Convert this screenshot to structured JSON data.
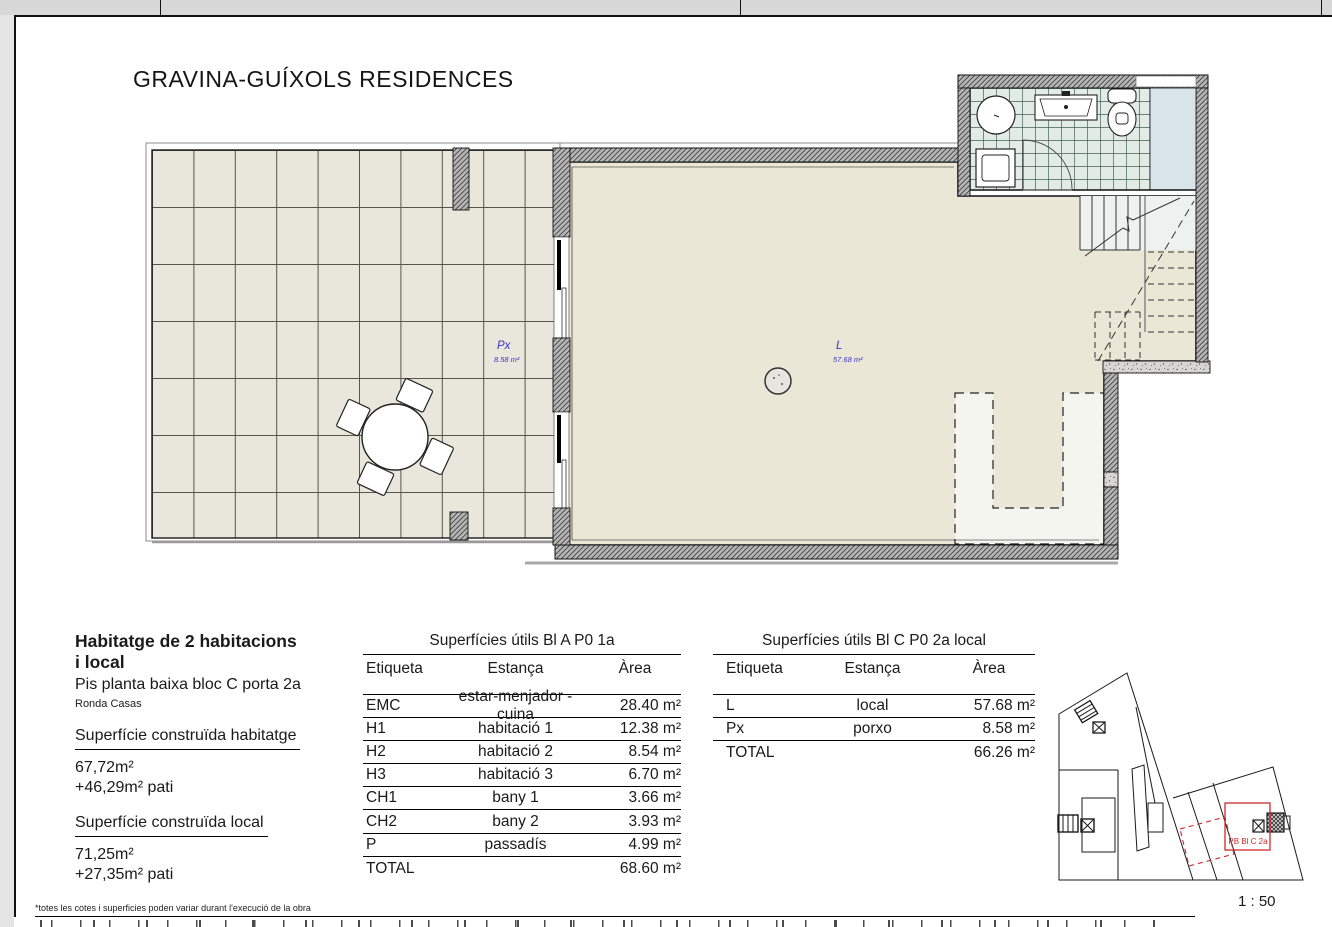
{
  "page": {
    "title": "GRAVINA-GUÍXOLS RESIDENCES",
    "scale_label": "1 : 50",
    "footnote": "*totes les cotes i superficies poden variar durant l'execució de la obra"
  },
  "plan": {
    "porxo_code": "Px",
    "porxo_area": "8.58 m²",
    "local_code": "L",
    "local_area": "57.68 m²"
  },
  "unit_info": {
    "title_line1": "Habitatge de 2 habitacions",
    "title_line2": "i local",
    "subtitle": "Pis planta baixa bloc C porta 2a",
    "address": "Ronda Casas",
    "built_dwelling_label": "Superfície construïda habitatge",
    "built_dwelling_area": "67,72m²",
    "built_dwelling_patio": "+46,29m² pati",
    "built_local_label": "Superfície construïda local",
    "built_local_area": "71,25m²",
    "built_local_patio": "+27,35m² pati"
  },
  "table_a": {
    "title": "Superfícies útils Bl A P0 1a",
    "col_label": "Etiqueta",
    "col_room": "Estança",
    "col_area": "Àrea",
    "rows": [
      {
        "label": "EMC",
        "room": "estar-menjador -cuina",
        "area": "28.40 m²"
      },
      {
        "label": "H1",
        "room": "habitació 1",
        "area": "12.38 m²"
      },
      {
        "label": "H2",
        "room": "habitació 2",
        "area": "8.54 m²"
      },
      {
        "label": "H3",
        "room": "habitació 3",
        "area": "6.70 m²"
      },
      {
        "label": "CH1",
        "room": "bany 1",
        "area": "3.66 m²"
      },
      {
        "label": "CH2",
        "room": "bany 2",
        "area": "3.93 m²"
      },
      {
        "label": "P",
        "room": "passadís",
        "area": "4.99 m²"
      }
    ],
    "total_label": "TOTAL",
    "total_area": "68.60 m²"
  },
  "table_c": {
    "title": "Superfícies útils Bl C P0 2a local",
    "col_label": "Etiqueta",
    "col_room": "Estança",
    "col_area": "Àrea",
    "rows": [
      {
        "label": "L",
        "room": "local",
        "area": "57.68 m²"
      },
      {
        "label": "Px",
        "room": "porxo",
        "area": "8.58 m²"
      }
    ],
    "total_label": "TOTAL",
    "total_area": "66.26 m²"
  },
  "key_plan": {
    "unit_label": "PB Bl C 2a"
  },
  "colors": {
    "room_floor": "#ebe7d7",
    "patio_floor": "#e9e6db",
    "bath_tiles": "#e3ebe7",
    "label_blue": "#3b35c8",
    "highlight_red": "#cc2a2a"
  }
}
